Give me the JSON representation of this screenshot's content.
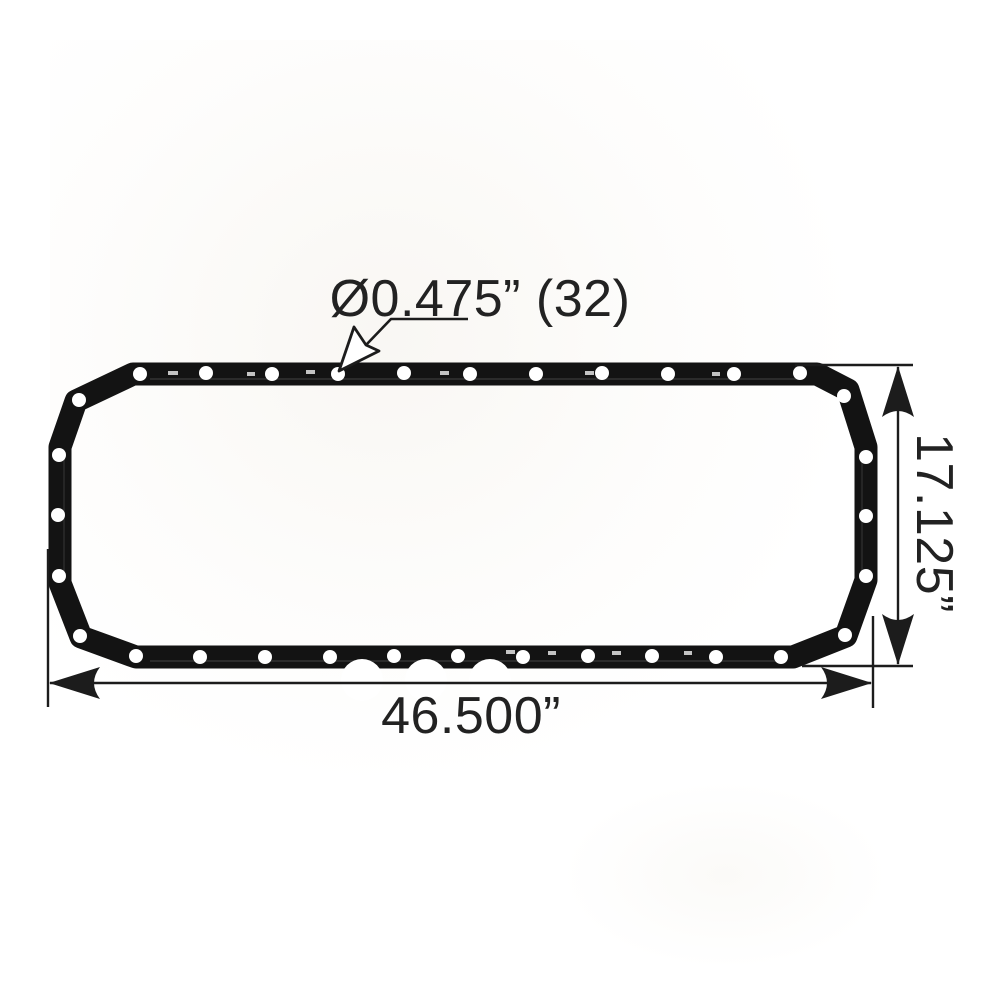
{
  "diagram": {
    "labels": {
      "hole_diameter": "Ø0.475” (32)",
      "overall_width": "46.500”",
      "overall_height": "17.125”"
    },
    "colors": {
      "ink": "#1c1c1c",
      "gasket": "#131313",
      "hole": "#ffffff",
      "background": "#ffffff"
    }
  }
}
